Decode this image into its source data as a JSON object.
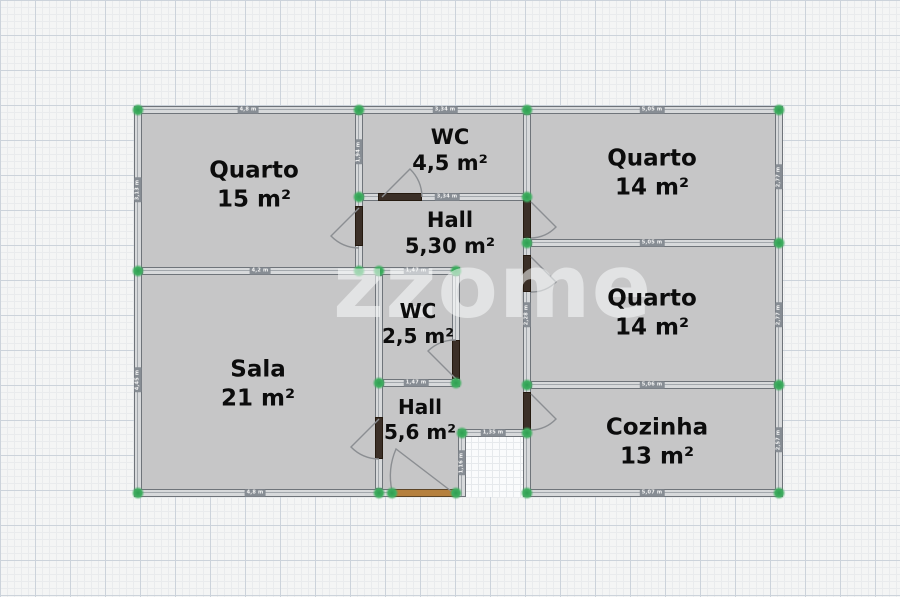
{
  "watermark": "zzome",
  "floorplan": {
    "rooms": [
      {
        "id": "quarto-1",
        "name": "Quarto",
        "area": "15 m²"
      },
      {
        "id": "wc-1",
        "name": "WC",
        "area": "4,5 m²"
      },
      {
        "id": "quarto-2",
        "name": "Quarto",
        "area": "14 m²"
      },
      {
        "id": "hall-1",
        "name": "Hall",
        "area": "5,30 m²"
      },
      {
        "id": "quarto-3",
        "name": "Quarto",
        "area": "14 m²"
      },
      {
        "id": "wc-2",
        "name": "WC",
        "area": "2,5 m²"
      },
      {
        "id": "sala",
        "name": "Sala",
        "area": "21 m²"
      },
      {
        "id": "hall-2",
        "name": "Hall",
        "area": "5,6 m²"
      },
      {
        "id": "cozinha",
        "name": "Cozinha",
        "area": "13 m²"
      }
    ],
    "dimensions": [
      {
        "text": "4,8 m"
      },
      {
        "text": "3,34 m"
      },
      {
        "text": "5,05 m"
      },
      {
        "text": "3,34 m"
      },
      {
        "text": "5,05 m"
      },
      {
        "text": "5,06 m"
      },
      {
        "text": "5,07 m"
      },
      {
        "text": "1,47 m"
      },
      {
        "text": "1,47 m"
      },
      {
        "text": "1,35 m"
      },
      {
        "text": "1,16 m"
      },
      {
        "text": "4,8 m"
      },
      {
        "text": "3,13 m"
      },
      {
        "text": "4,45 m"
      },
      {
        "text": "2,77 m"
      },
      {
        "text": "2,77 m"
      },
      {
        "text": "2,57 m"
      },
      {
        "text": "1,94 m"
      },
      {
        "text": "2,28 m"
      },
      {
        "text": "4,2 m"
      }
    ],
    "colors": {
      "room_fill": "#c6c6c7",
      "wall_fill": "#d7d9db",
      "wall_edge": "#6f747a",
      "node_marker": "#3fae60",
      "door_leaf": "#3b2f27",
      "entrance_door": "#b5803e"
    }
  }
}
